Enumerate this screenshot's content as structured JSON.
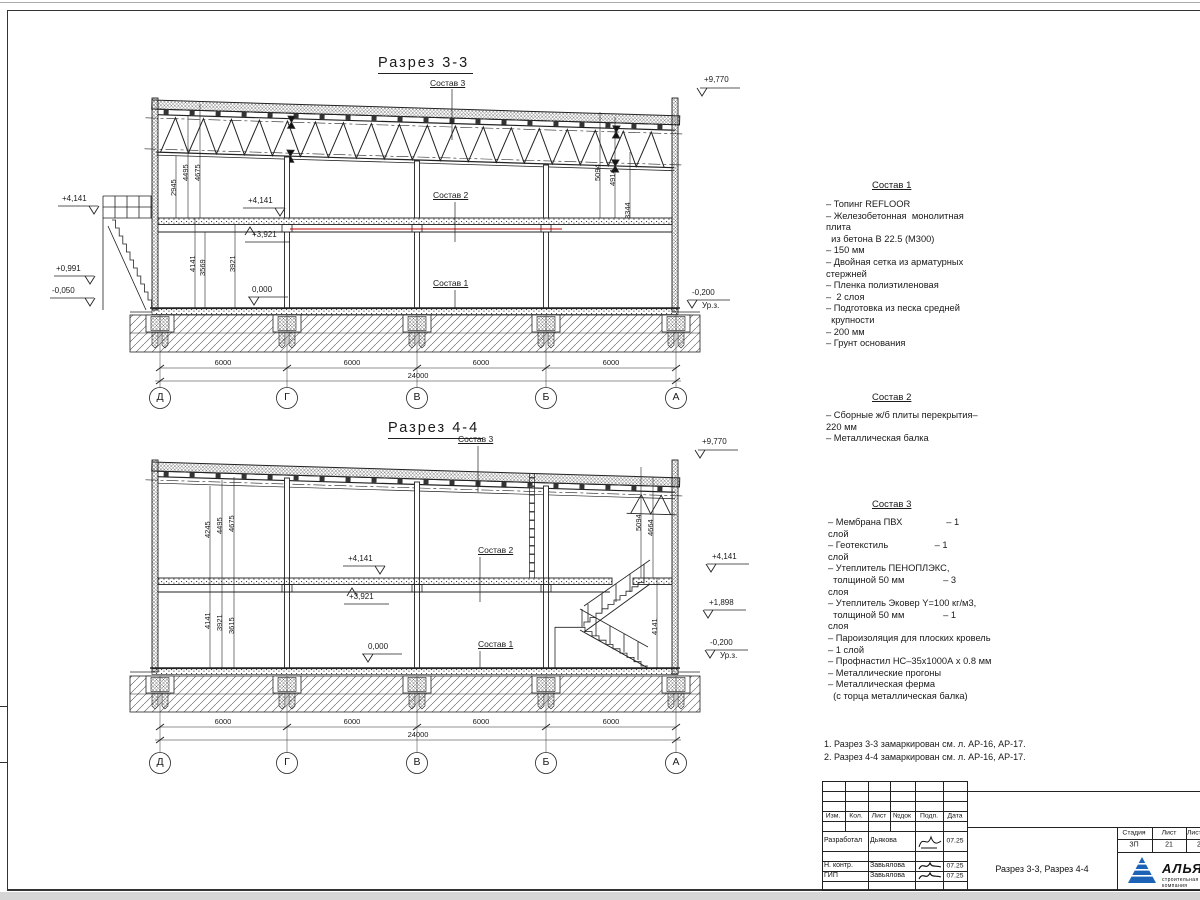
{
  "section1": {
    "title": "Разрез 3-3",
    "label_sostav3": "Состав 3",
    "label_sostav2": "Состав 2",
    "label_sostav1": "Состав 1",
    "elev_roof": "+9,770",
    "elev_left_top": "+4,141",
    "elev_left_mid": "+0,991",
    "elev_left_low": "-0,050",
    "elev_mid_top": "+4,141",
    "elev_mid_slab": "+3,921",
    "elev_zero": "0,000",
    "elev_ground": "-0,200",
    "elev_ground_label": "Ур.з.",
    "vdim_truss": "2945",
    "vdim_deck": "4495",
    "vdim_roof": "4675",
    "vdim_floor1": "4141",
    "vdim_floor2": "3569",
    "vdim_floor3": "3921",
    "vdim_right1": "5094",
    "vdim_right2": "4914",
    "vdim_right3": "3344",
    "hdims": [
      "6000",
      "6000",
      "6000",
      "6000"
    ],
    "total_dim": "24000",
    "grid": [
      "Д",
      "Г",
      "В",
      "Б",
      "А"
    ]
  },
  "section2": {
    "title": "Разрез 4-4",
    "label_sostav3": "Состав 3",
    "label_sostav2": "Состав 2",
    "label_sostav1": "Состав 1",
    "elev_roof": "+9,770",
    "elev_mid_top": "+4,141",
    "elev_mid_slab": "+3,921",
    "elev_zero": "0,000",
    "elev_right_top": "+4,141",
    "elev_right_mid": "+1,898",
    "elev_ground": "-0,200",
    "elev_ground_label": "Ур.з.",
    "vdim_left_top1": "4245",
    "vdim_left_top2": "4495",
    "vdim_left_top3": "4675",
    "vdim_left_bot1": "4141",
    "vdim_left_bot2": "3921",
    "vdim_left_bot3": "3615",
    "vdim_right1": "5094",
    "vdim_right2": "4664",
    "vdim_stair": "4141",
    "hdims": [
      "6000",
      "6000",
      "6000",
      "6000"
    ],
    "total_dim": "24000",
    "grid": [
      "Д",
      "Г",
      "В",
      "Б",
      "А"
    ]
  },
  "sostav1": {
    "title": "Состав 1",
    "lines": [
      "– Топинг REFLOOR",
      "– Железобетонная  монолитная",
      "плита",
      "  из бетона В 22.5 (М300)",
      "– 150 мм",
      "– Двойная сетка из арматурных",
      "стержней",
      "– Пленка полиэтиленовая",
      "–  2 слоя",
      "– Подготовка из песка средней",
      "  крупности",
      "– 200 мм",
      "– Грунт основания"
    ]
  },
  "sostav2": {
    "title": "Состав 2",
    "lines": [
      "– Сборные ж/б плиты перекрытия–",
      "220 мм",
      "– Металлическая балка"
    ]
  },
  "sostav3": {
    "title": "Состав 3",
    "lines": [
      "– Мембрана ПВХ                 – 1",
      "слой",
      "– Геотекстиль                  – 1",
      "слой",
      "– Утеплитель ПЕНОПЛЭКС,",
      "  толщиной 50 мм               – 3",
      "слоя",
      "– Утеплитель Эковер Y=100 кг/м3,",
      "  толщиной 50 мм               – 1",
      "слоя",
      "– Пароизоляция для плоских кровель",
      "– 1 слой",
      "– Профнастил НС–35х1000А х 0.8 мм",
      "– Металлические прогоны",
      "– Металлическая ферма",
      "  (с торца металлическая балка)"
    ]
  },
  "notes": {
    "line1": "1. Разрез 3-3 замаркирован см. л. АР-16, АР-17.",
    "line2": "2. Разрез 4-4 замаркирован см. л. АР-16, АР-17."
  },
  "titleblock": {
    "col_izm": "Изм.",
    "col_kol": "Кол.",
    "col_list": "Лист",
    "col_ndok": "№док",
    "col_podp": "Подп.",
    "col_data": "Дата",
    "row1_role": "Разработал",
    "row1_name": "Дьякова",
    "row1_date": "07.25",
    "row2_role": "Н. контр.",
    "row2_name": "Завьялова",
    "row2_date": "07.25",
    "row3_role": "ГИП",
    "row3_name": "Завьялова",
    "row3_date": "07.25",
    "doc_title": "Разрез 3-3, Разрез 4-4",
    "stage_header": "Стадия",
    "sheet_header": "Лист",
    "sheets_header": "Листов",
    "stage": "ЗП",
    "sheet": "21",
    "sheets": "2",
    "company": "АЛЬЯНС",
    "tagline": "строительная компания"
  }
}
